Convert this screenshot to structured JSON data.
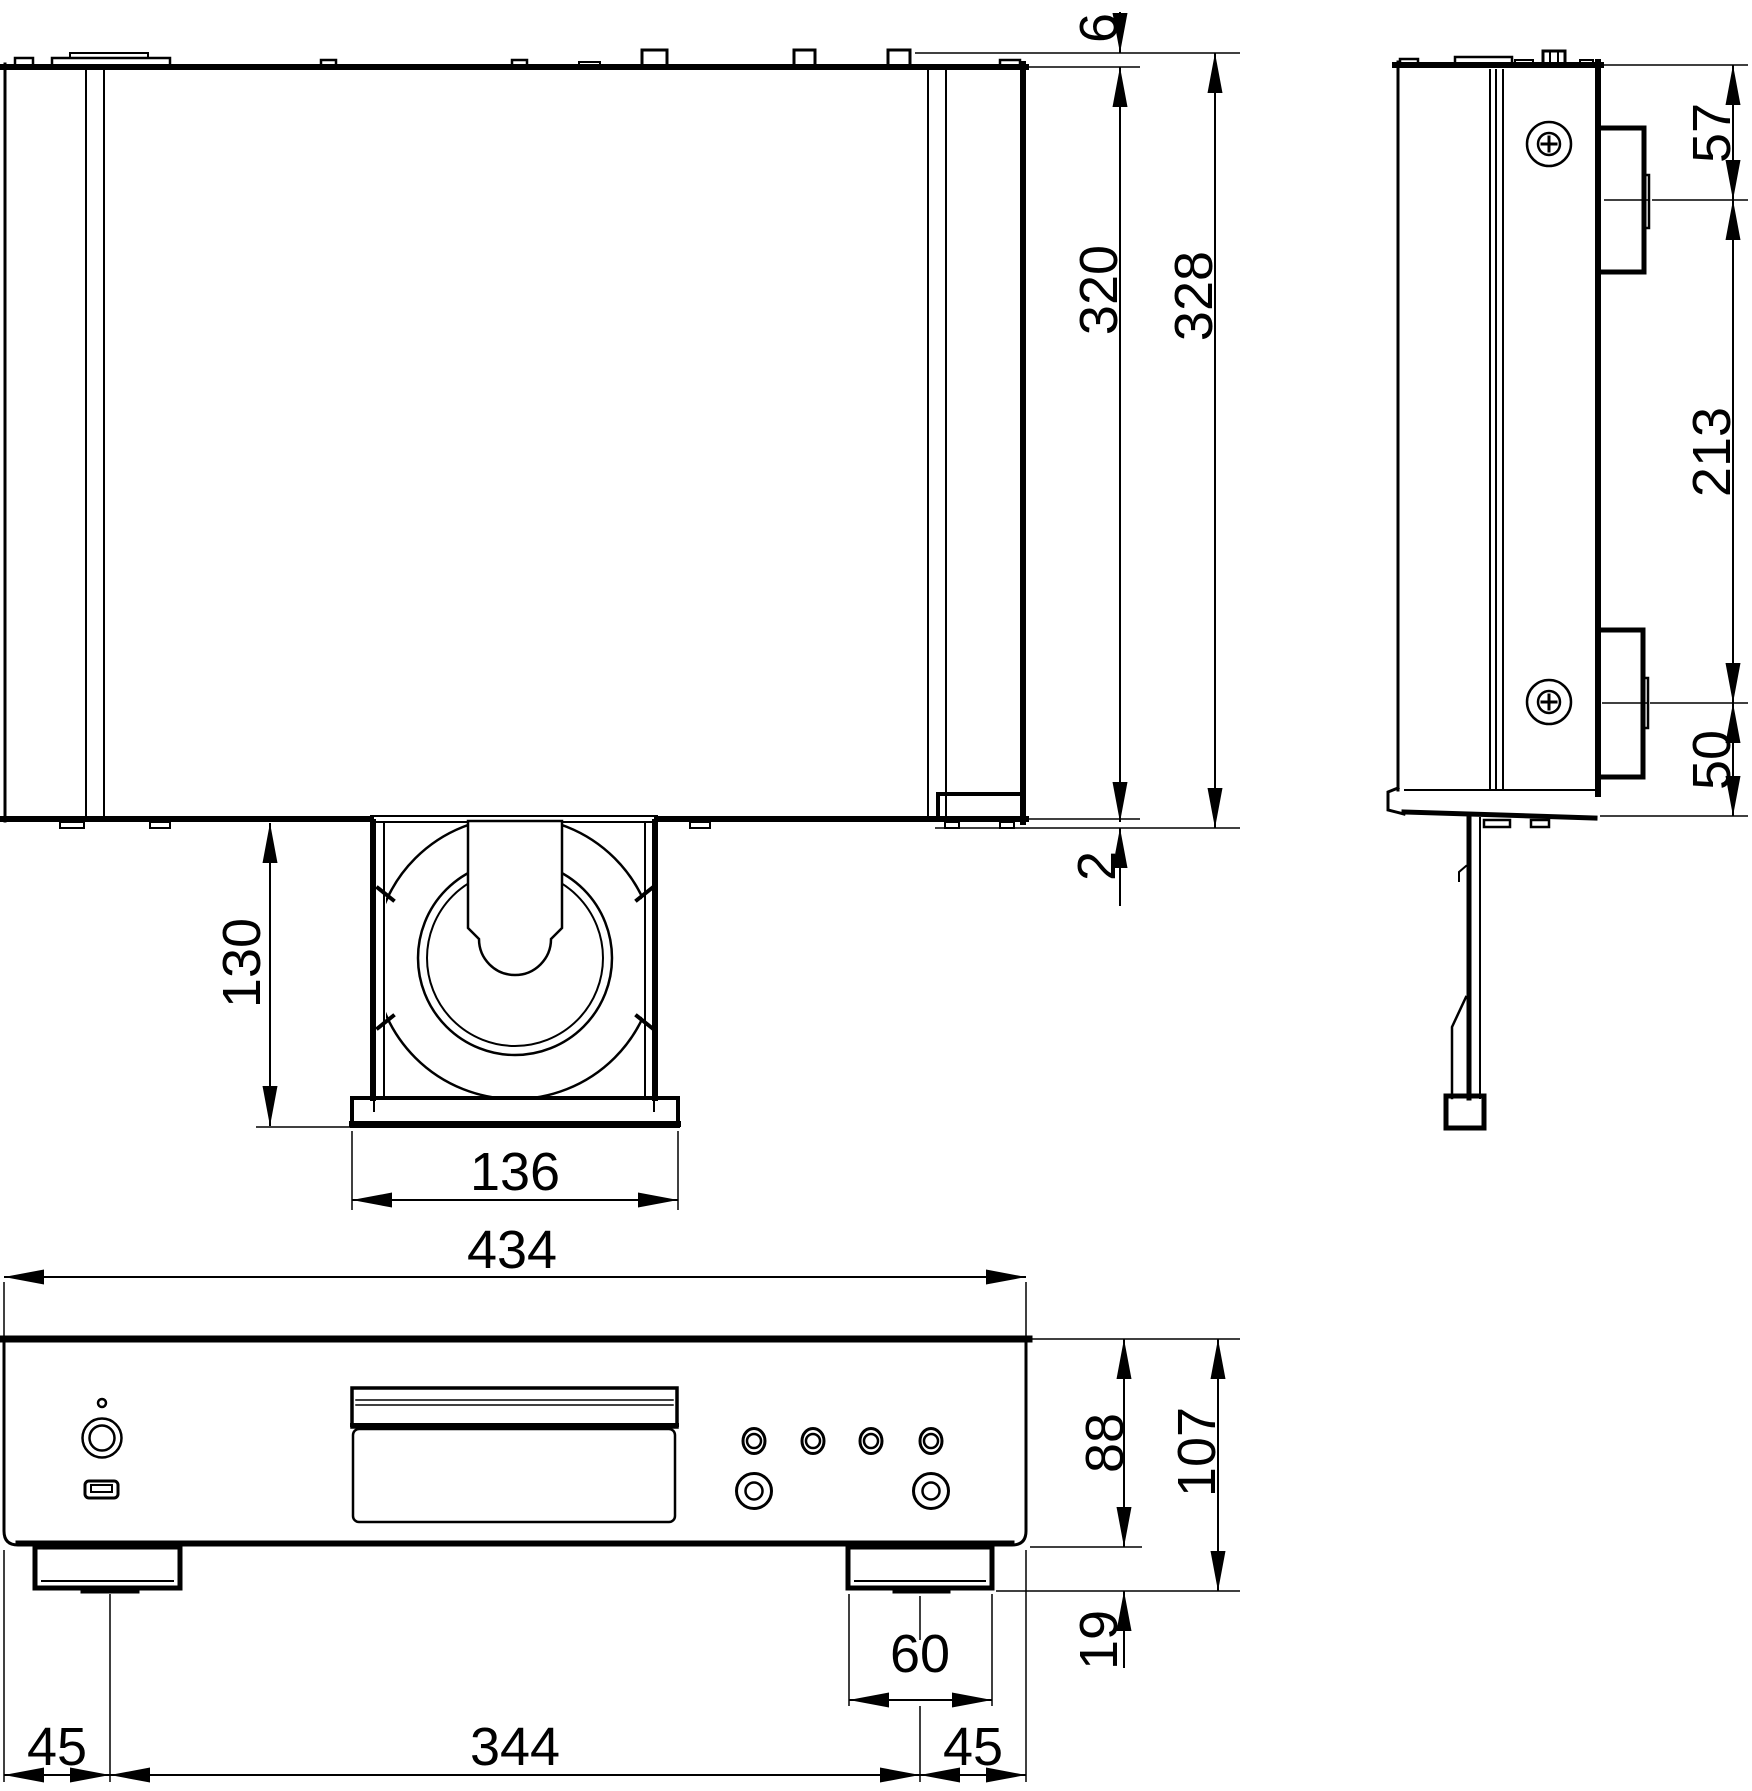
{
  "drawing_colors": {
    "line": "#000000",
    "background": "#ffffff"
  },
  "dimensions": {
    "top_view": {
      "rear_protrusion": "6",
      "chassis_depth": "320",
      "total_depth": "328",
      "front_protrusion": "2",
      "tray_extension": "130",
      "tray_width": "136"
    },
    "front_view": {
      "total_width": "434",
      "panel_height": "88",
      "total_height": "107",
      "foot_height": "19",
      "foot_width": "60",
      "left_foot_offset": "45",
      "feet_span": "344",
      "right_foot_offset": "45"
    },
    "side_view": {
      "top_to_foot": "57",
      "feet_spacing": "213",
      "foot_to_bottom": "50"
    }
  }
}
